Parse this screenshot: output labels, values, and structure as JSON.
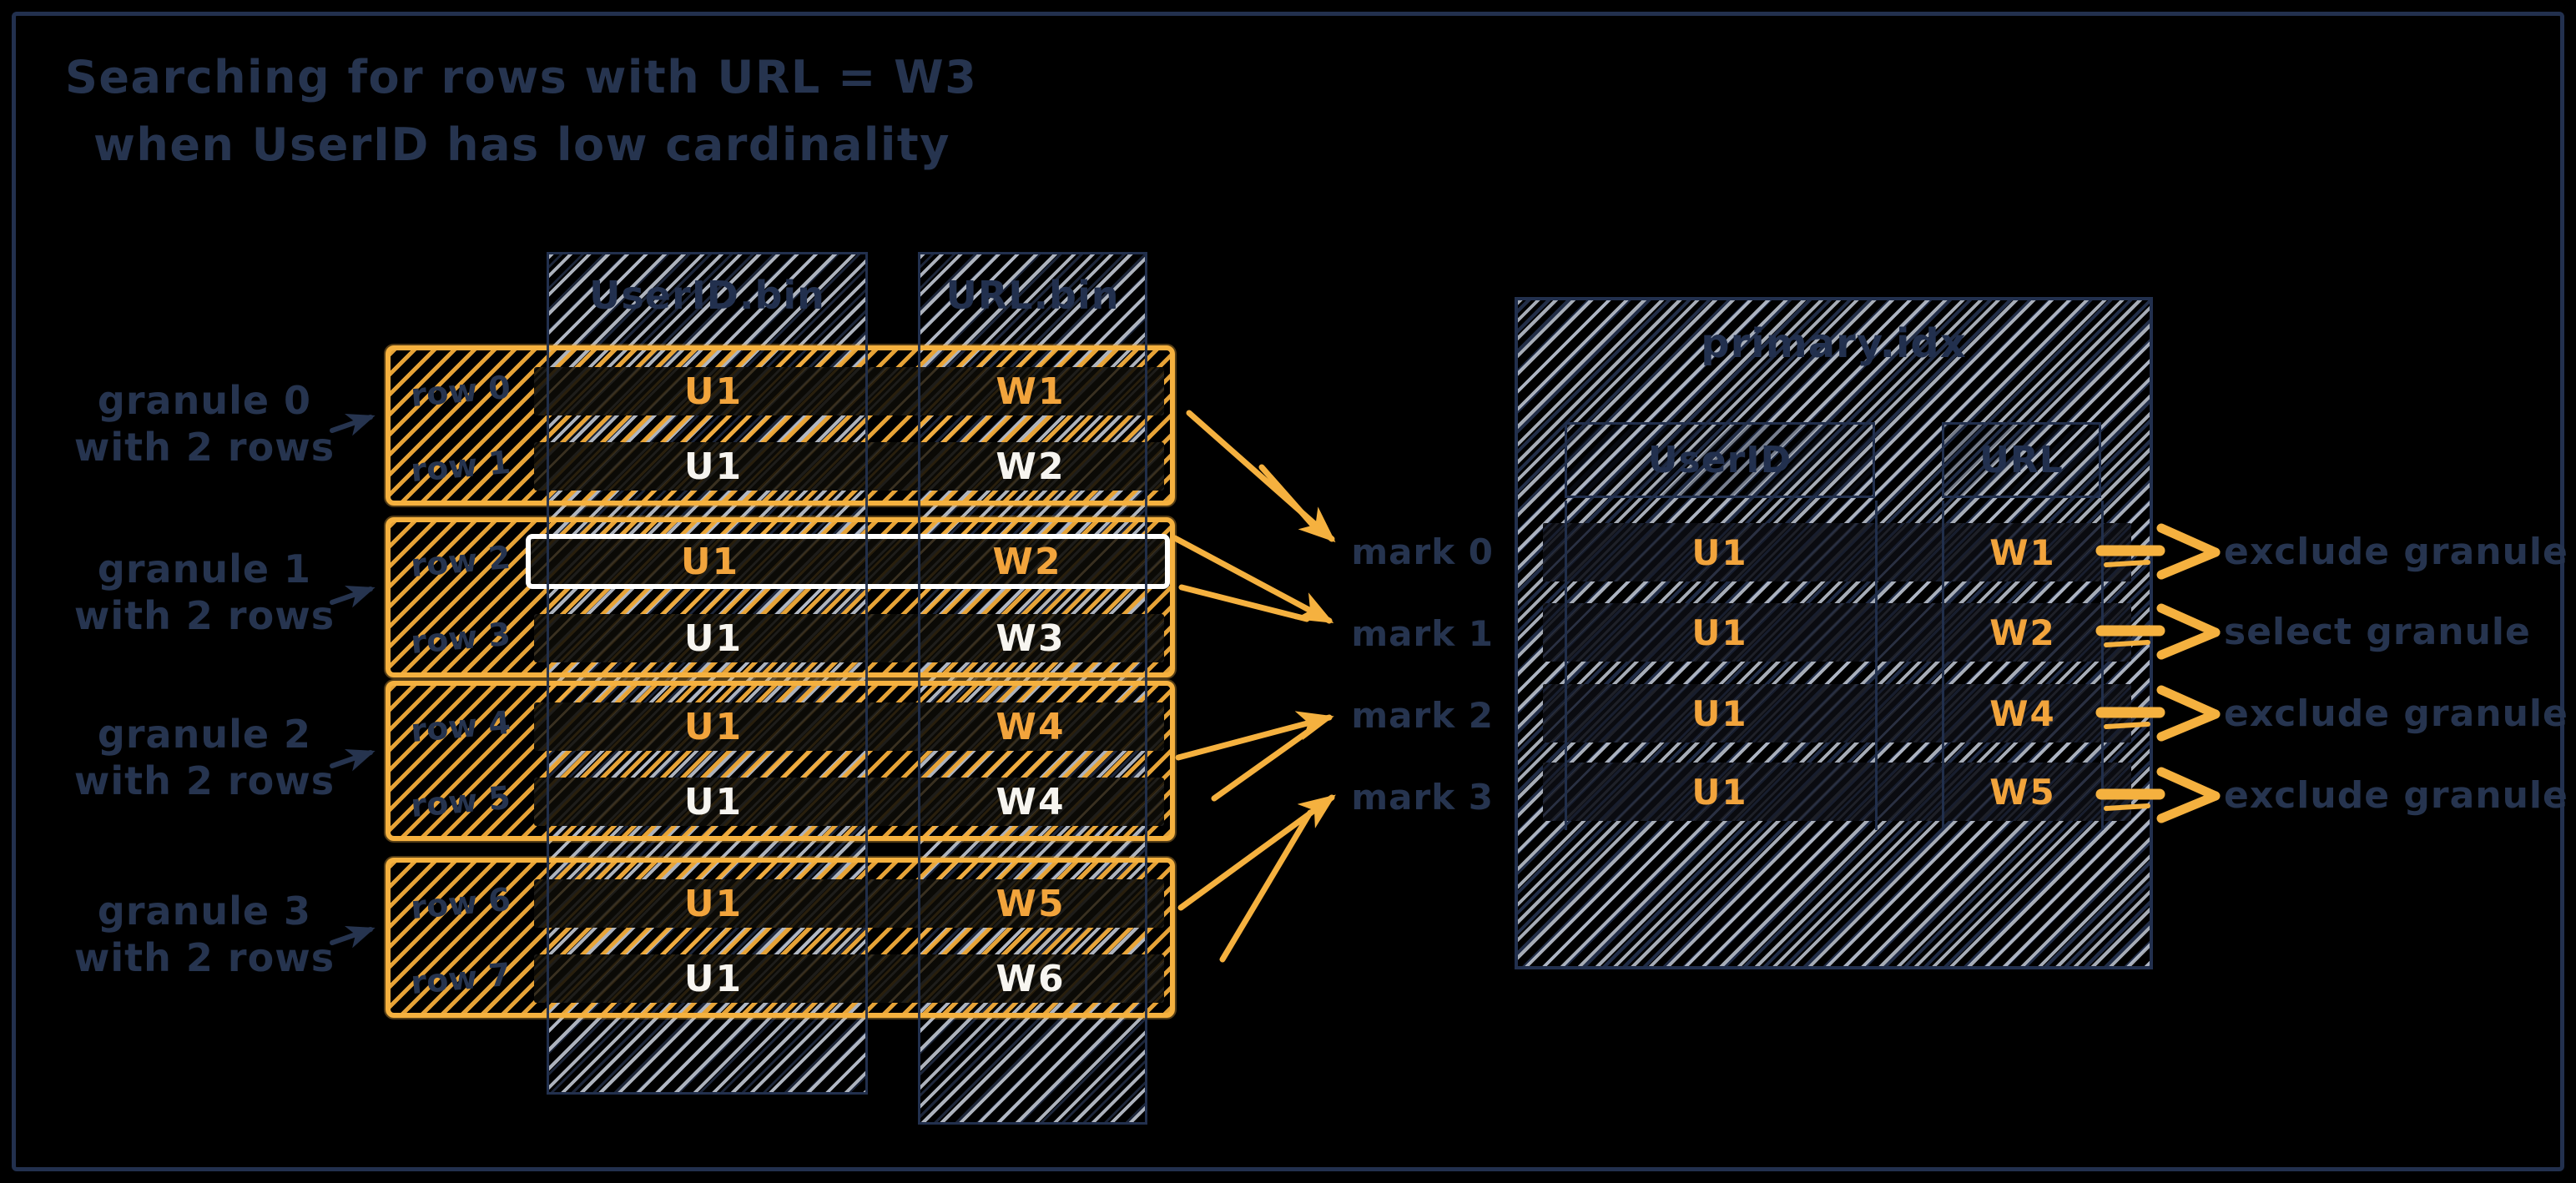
{
  "title": {
    "line1": "Searching for rows with URL = W3",
    "line2": "when UserID has low cardinality"
  },
  "colors": {
    "background": "#000000",
    "accent_yellow": "#f5b13f",
    "orange_value_text": "#f2a43c",
    "navy_text": "#26344f",
    "white_value_text": "#f7f5f0",
    "gray_hatch": "#cbd2de"
  },
  "bin_columns": {
    "userid_header": "UserID.bin",
    "url_header": "URL.bin"
  },
  "granules": [
    {
      "label_line1": "granule 0",
      "label_line2": "with 2 rows",
      "rows": [
        {
          "row_label": "row 0",
          "userid": "U1",
          "url": "W1",
          "highlighted": false
        },
        {
          "row_label": "row 1",
          "userid": "U1",
          "url": "W2",
          "highlighted": false
        }
      ]
    },
    {
      "label_line1": "granule 1",
      "label_line2": "with 2 rows",
      "rows": [
        {
          "row_label": "row 2",
          "userid": "U1",
          "url": "W2",
          "highlighted": true
        },
        {
          "row_label": "row 3",
          "userid": "U1",
          "url": "W3",
          "highlighted": false
        }
      ]
    },
    {
      "label_line1": "granule 2",
      "label_line2": "with 2 rows",
      "rows": [
        {
          "row_label": "row 4",
          "userid": "U1",
          "url": "W4",
          "highlighted": false
        },
        {
          "row_label": "row 5",
          "userid": "U1",
          "url": "W4",
          "highlighted": false
        }
      ]
    },
    {
      "label_line1": "granule 3",
      "label_line2": "with 2 rows",
      "rows": [
        {
          "row_label": "row 6",
          "userid": "U1",
          "url": "W5",
          "highlighted": false
        },
        {
          "row_label": "row 7",
          "userid": "U1",
          "url": "W6",
          "highlighted": false
        }
      ]
    }
  ],
  "marks": [
    "mark 0",
    "mark 1",
    "mark 2",
    "mark 3"
  ],
  "primary_index": {
    "title": "primary.idx",
    "userid_header": "UserID",
    "url_header": "URL",
    "rows": [
      {
        "userid": "U1",
        "url": "W1"
      },
      {
        "userid": "U1",
        "url": "W2"
      },
      {
        "userid": "U1",
        "url": "W4"
      },
      {
        "userid": "U1",
        "url": "W5"
      }
    ]
  },
  "outcomes": [
    "exclude granule",
    "select granule",
    "exclude granule",
    "exclude granule"
  ]
}
